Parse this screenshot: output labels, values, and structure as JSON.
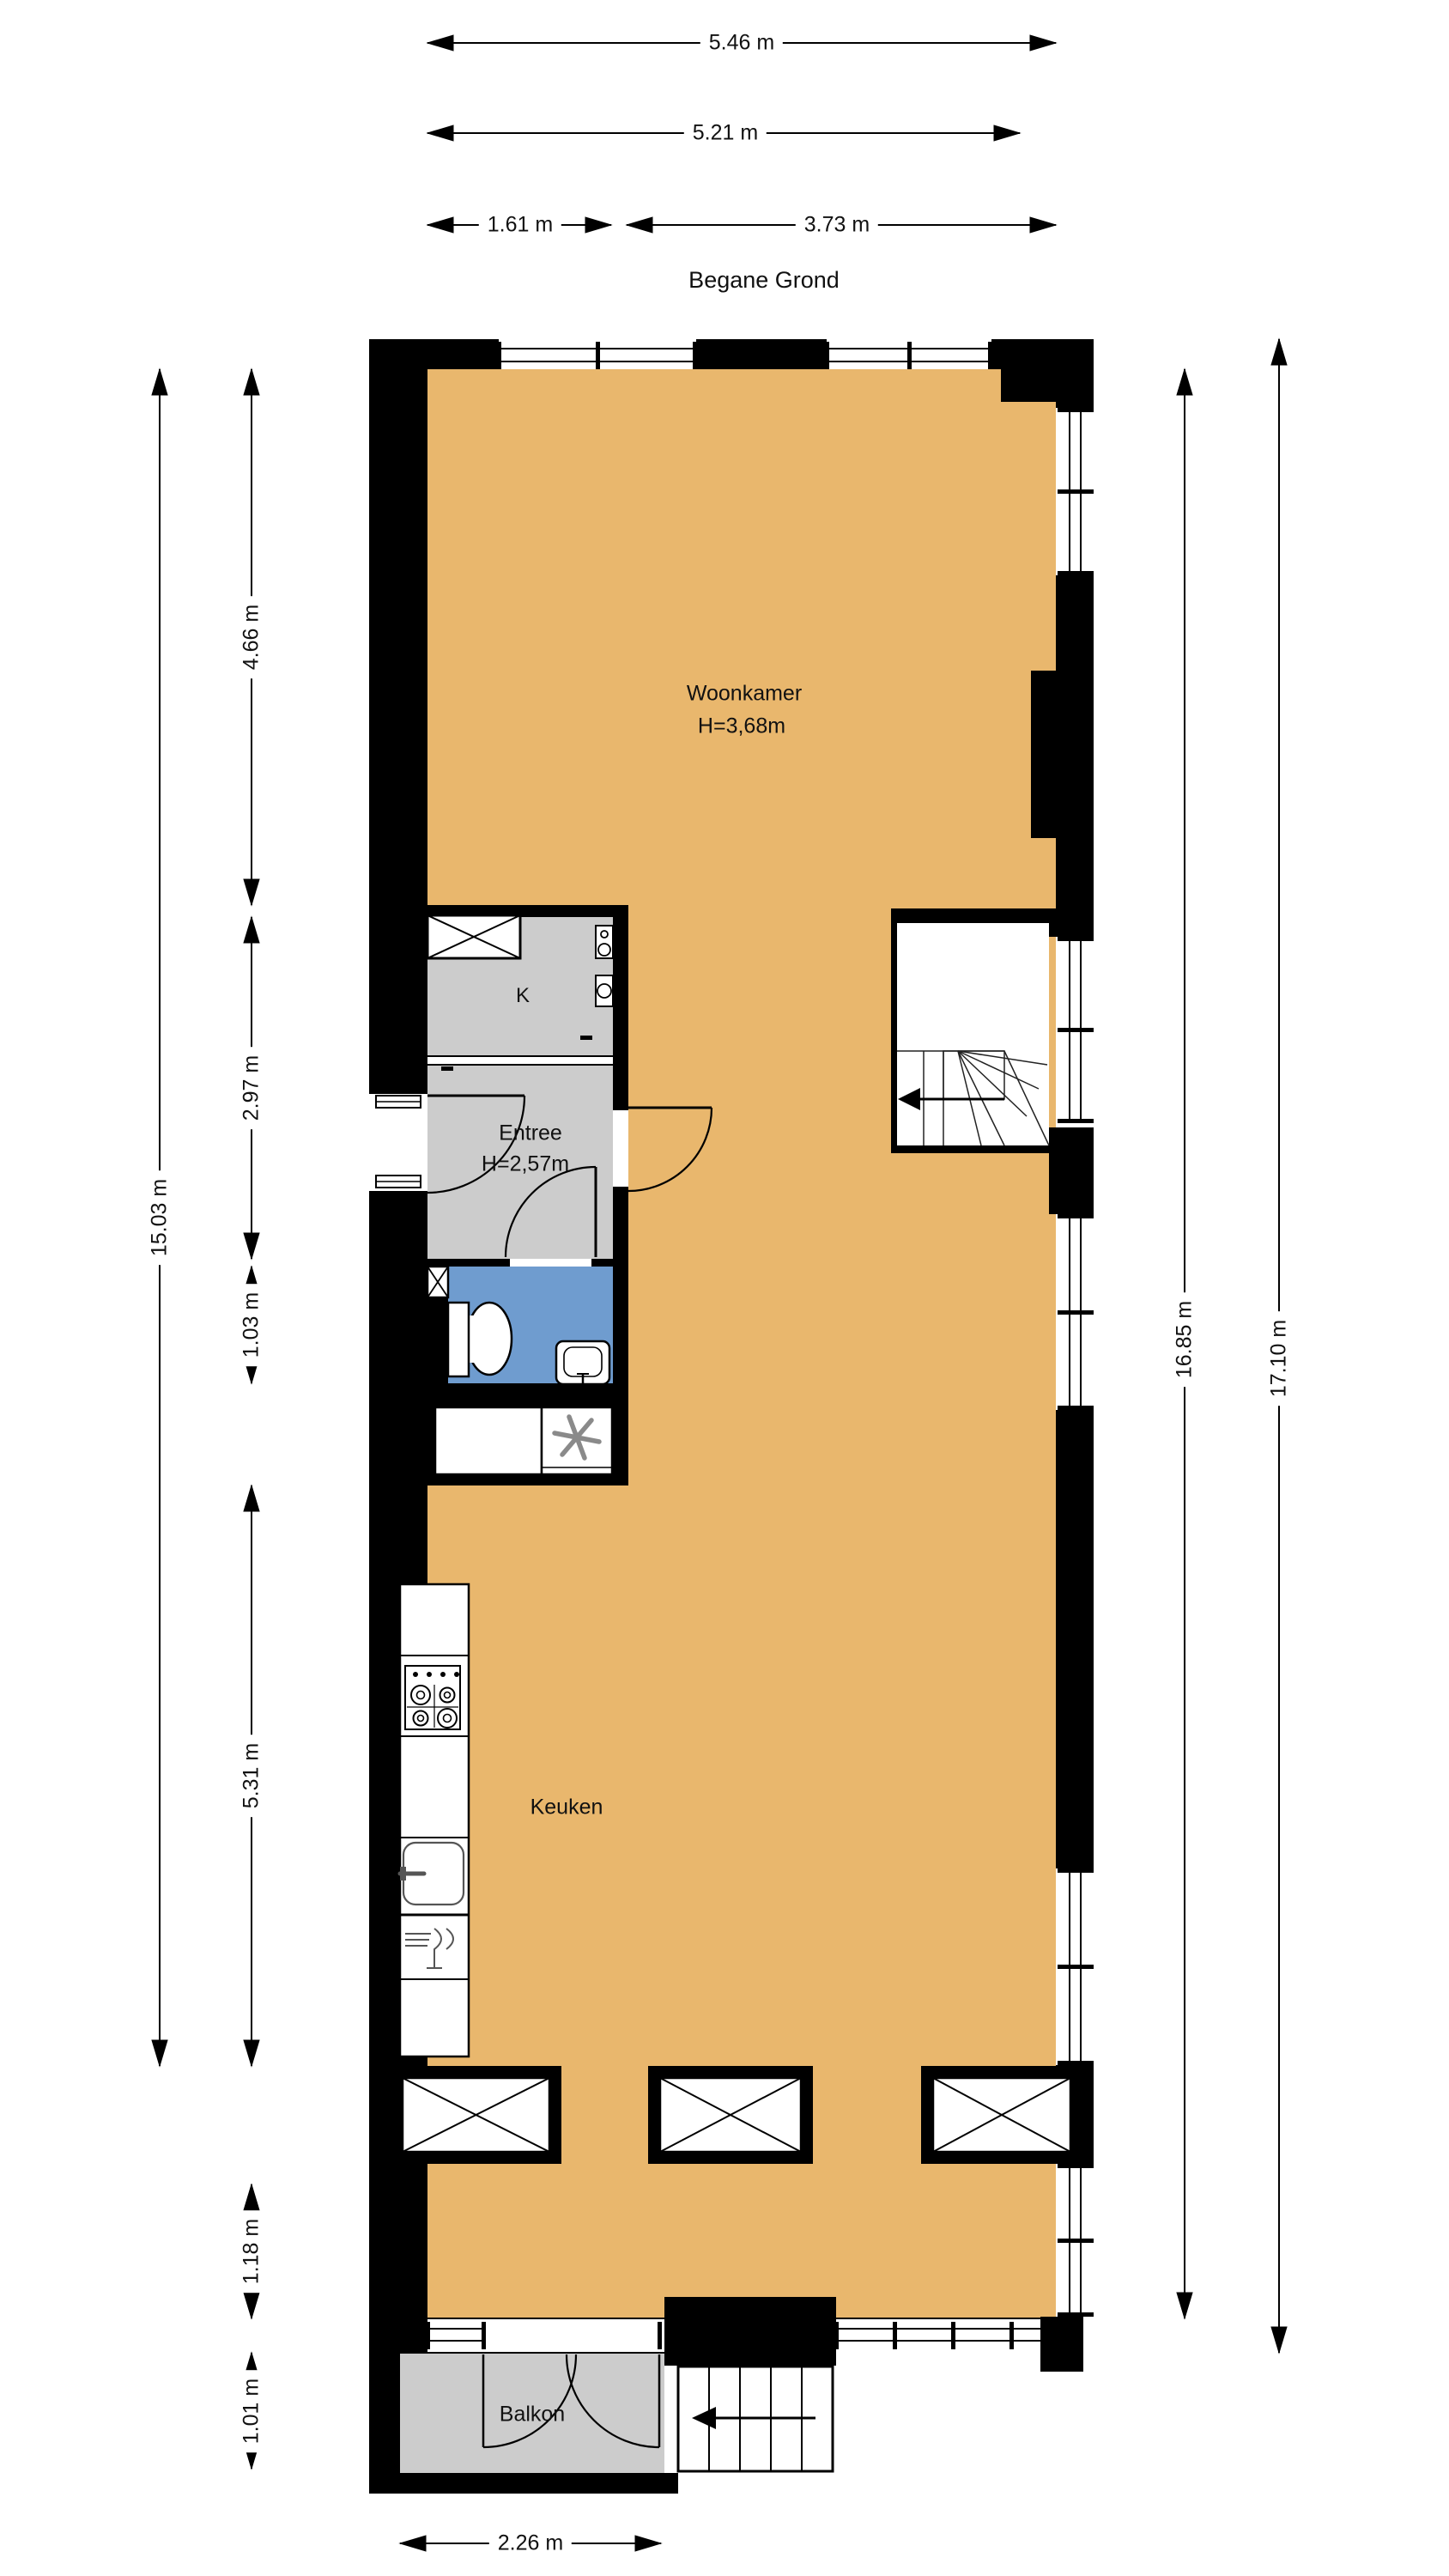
{
  "title": "Begane Grond",
  "colors": {
    "floor_wood": "#E9B76D",
    "floor_gray": "#CCCCCC",
    "bath_blue": "#6F9CCF",
    "wall": "#000000"
  },
  "dimensions": {
    "top": [
      {
        "label": "5.46 m"
      },
      {
        "label": "5.21 m"
      },
      {
        "label": "1.61 m"
      },
      {
        "label": "3.73 m"
      }
    ],
    "left": [
      {
        "label": "15.03 m"
      },
      {
        "label": "4.66 m"
      },
      {
        "label": "2.97 m"
      },
      {
        "label": "1.03 m"
      },
      {
        "label": "5.31 m"
      },
      {
        "label": "1.18 m"
      },
      {
        "label": "1.01 m"
      }
    ],
    "right": [
      {
        "label": "16.85 m"
      },
      {
        "label": "17.10 m"
      }
    ],
    "bottom": [
      {
        "label": "2.26 m"
      }
    ]
  },
  "rooms": {
    "woonkamer": {
      "name": "Woonkamer",
      "ceiling_height": "H=3,68m"
    },
    "kast": {
      "name": "K"
    },
    "entree": {
      "name": "Entree",
      "ceiling_height": "H=2,57m"
    },
    "keuken": {
      "name": "Keuken"
    },
    "balkon": {
      "name": "Balkon"
    }
  },
  "icons": [
    "stove-icon",
    "kitchen-sink-icon",
    "dishwasher-icon",
    "toilet-icon",
    "washbasin-icon",
    "ventilation-fan-icon",
    "boiler-icon",
    "shaft-x-icon",
    "stair-direction-arrow-icon",
    "door-swing-icon",
    "window-icon"
  ]
}
